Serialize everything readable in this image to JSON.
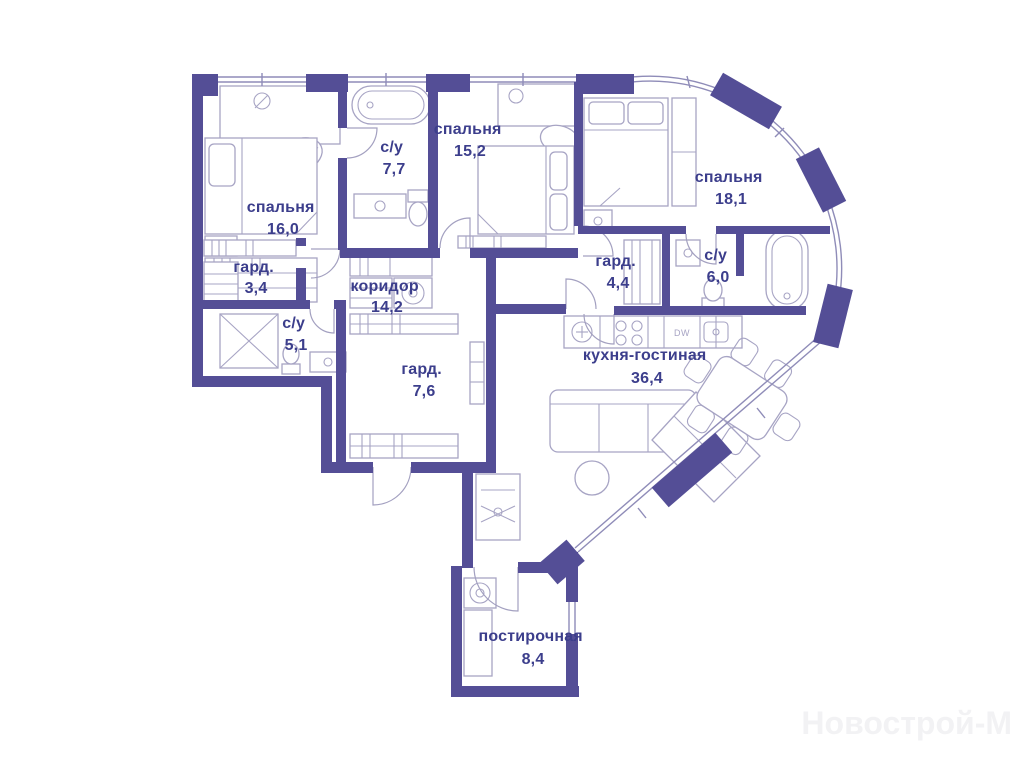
{
  "plan": {
    "type": "apartment-floor-plan",
    "wall_color": "#544e96",
    "label_color": "#3c3e8c",
    "furniture_color": "#a7a4c4"
  },
  "rooms": [
    {
      "name": "спальня",
      "area": "16,0"
    },
    {
      "name": "с/у",
      "area": "7,7"
    },
    {
      "name": "спальня",
      "area": "15,2"
    },
    {
      "name": "спальня",
      "area": "18,1"
    },
    {
      "name": "гард.",
      "area": "3,4"
    },
    {
      "name": "коридор",
      "area": "14,2"
    },
    {
      "name": "гард.",
      "area": "4,4"
    },
    {
      "name": "с/у",
      "area": "6,0"
    },
    {
      "name": "с/у",
      "area": "5,1"
    },
    {
      "name": "гард.",
      "area": "7,6"
    },
    {
      "name": "кухня-гостиная",
      "area": "36,4"
    },
    {
      "name": "постирочная",
      "area": "8,4"
    }
  ],
  "appliance_labels": {
    "dishwasher": "DW"
  },
  "watermark": {
    "text": "Новострой-М"
  }
}
